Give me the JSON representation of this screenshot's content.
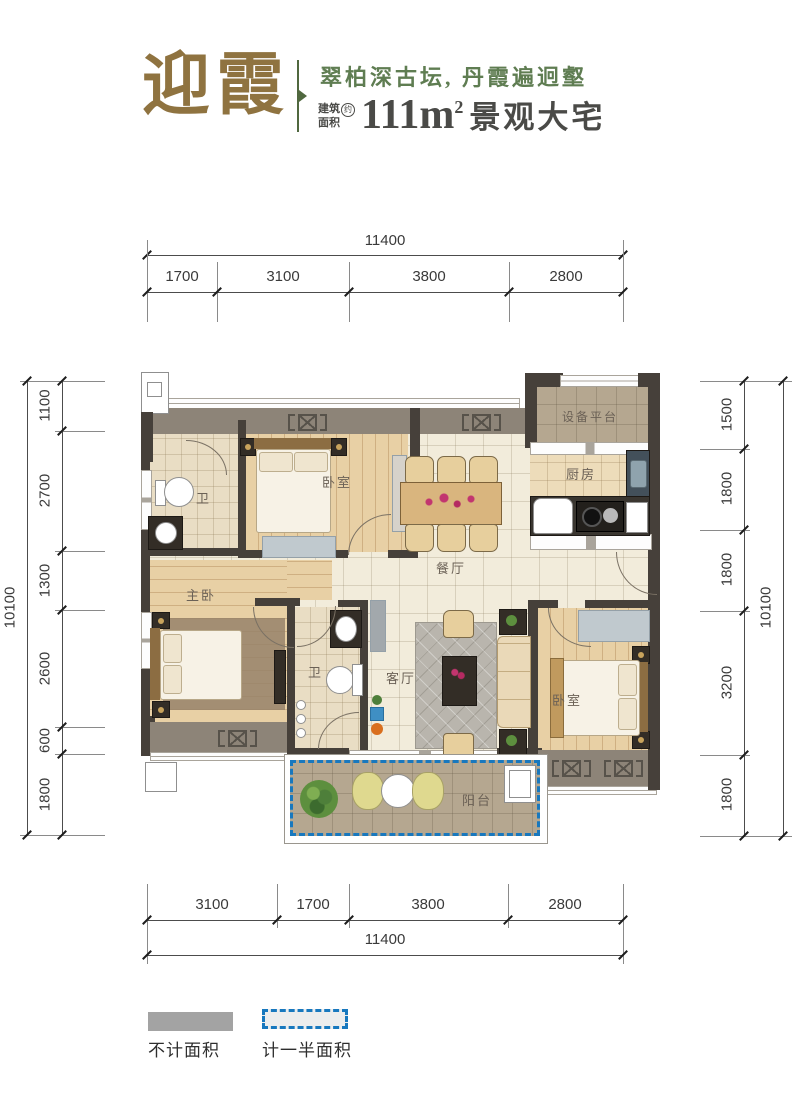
{
  "header": {
    "title": "迎霞",
    "tagline": "翠柏深古坛, 丹霞遍迥壑",
    "area_label_line1": "建筑",
    "area_label_line2": "面积",
    "area_approx": "约",
    "area_value": "111m",
    "area_sup": "2",
    "area_suffix": "景观大宅",
    "colors": {
      "gold": "#8f7340",
      "green": "#5f7d52",
      "dark": "#4a4a47"
    }
  },
  "dimensions": {
    "top": {
      "total": "11400",
      "segments": [
        "1700",
        "3100",
        "3800",
        "2800"
      ]
    },
    "bottom": {
      "total": "11400",
      "segments": [
        "3100",
        "1700",
        "3800",
        "2800"
      ]
    },
    "left": {
      "total": "10100",
      "segments": [
        "1100",
        "2700",
        "1300",
        "2600",
        "600",
        "1800"
      ]
    },
    "right": {
      "total": "10100",
      "segments": [
        "1500",
        "1800",
        "1800",
        "3200",
        "1800"
      ]
    }
  },
  "rooms": {
    "bedroom_top": {
      "label": "卧室"
    },
    "bath_top": {
      "label": "卫"
    },
    "dining": {
      "label": "餐厅"
    },
    "equipment": {
      "label": "设备平台"
    },
    "kitchen": {
      "label": "厨房"
    },
    "master": {
      "label": "主卧"
    },
    "bath_mid": {
      "label": "卫"
    },
    "living": {
      "label": "客厅"
    },
    "bedroom_right": {
      "label": "卧室"
    },
    "balcony": {
      "label": "阳台"
    }
  },
  "legend": {
    "items": [
      {
        "label": "不计面积"
      },
      {
        "label": "计一半面积"
      }
    ]
  },
  "plan_colors": {
    "wall_dark": "#46403a",
    "wall_gray": "#8d8478",
    "half_area_blue": "#1878be"
  }
}
